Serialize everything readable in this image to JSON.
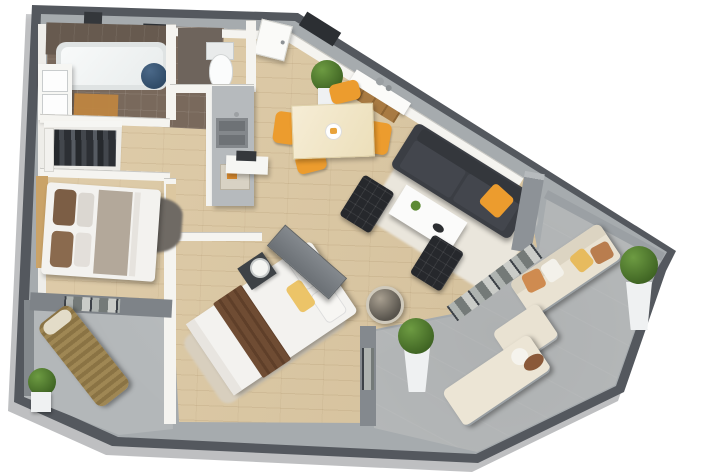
{
  "meta": {
    "kind": "3d-isometric-floor-plan-render",
    "description": "Photoreal 3D cutaway floor plan of an apartment with two bedrooms, open living/dining/kitchen, bathroom, WC, walk-in closet, a rear balcony and a large wrap-around terrace",
    "visible_text": ""
  },
  "colors": {
    "wood": "#dcc7a0",
    "wallwhite": "#f5f4f0",
    "walltop": "#a6abae",
    "outerwall": "#54585e",
    "terrace": "#b9bcbd",
    "balconyfloor": "#b3b7b9",
    "tile": "#79695c",
    "tilewall": "#675a4f",
    "orange": "#ec9c2e",
    "sofadark": "#3b3e44",
    "chairblack": "#26282c",
    "cream": "#e9e2d2",
    "ruglight": "#eae6dc",
    "rugbeige": "#d8cfbe",
    "rugdark": "#6f6a64",
    "bedwhite": "#f3f2ef",
    "taupe": "#b3a89a",
    "brown": "#6f4c33",
    "pillowbrown": "#7c5e45",
    "yellow": "#ecc468",
    "wicker": "#a18a58",
    "green": "#4e7c30",
    "planter": "#eff1f2",
    "counter": "#b6babd",
    "sink": "#84888c",
    "basketblue": "#3f5d7c",
    "graywall": "#84898e"
  },
  "rooms": [
    {
      "id": "bathroom",
      "label": "bathroom",
      "furniture": [
        "bathtub",
        "double-vanity-sink",
        "laundry-basket",
        "orange-bath-mat"
      ]
    },
    {
      "id": "wc",
      "label": "wc",
      "furniture": [
        "toilet"
      ]
    },
    {
      "id": "closet",
      "label": "walk-in-closet",
      "furniture": [
        "hanging-clothes",
        "shelves"
      ]
    },
    {
      "id": "kitchen",
      "label": "kitchen",
      "furniture": [
        "counter",
        "double-sink",
        "small-appliance"
      ]
    },
    {
      "id": "dining",
      "label": "dining-area",
      "furniture": [
        "dining-table",
        "orange-chair-x4",
        "sideboard",
        "potted-plant",
        "entry-door"
      ]
    },
    {
      "id": "living",
      "label": "living-room",
      "furniture": [
        "dark-sofa",
        "orange-cushion",
        "white-coffee-table",
        "black-lounge-chair-x2",
        "shag-rug",
        "basket-floor-lamp"
      ]
    },
    {
      "id": "bedroom1",
      "label": "bedroom-1",
      "furniture": [
        "double-bed",
        "brown-pillows",
        "dark-rug",
        "wood-headboard"
      ]
    },
    {
      "id": "bedroom2",
      "label": "bedroom-2",
      "furniture": [
        "double-bed",
        "yellow-pillow",
        "brown-throw",
        "nightstand",
        "table-lamp",
        "tv-panel",
        "beige-rug"
      ]
    },
    {
      "id": "balcony",
      "label": "balcony",
      "furniture": [
        "wicker-lounger",
        "boxwood-plant"
      ]
    },
    {
      "id": "terrace",
      "label": "terrace",
      "furniture": [
        "outdoor-sofa",
        "ottoman",
        "sun-lounger",
        "planter-plant-x2",
        "glass-sliding-doors"
      ]
    }
  ]
}
